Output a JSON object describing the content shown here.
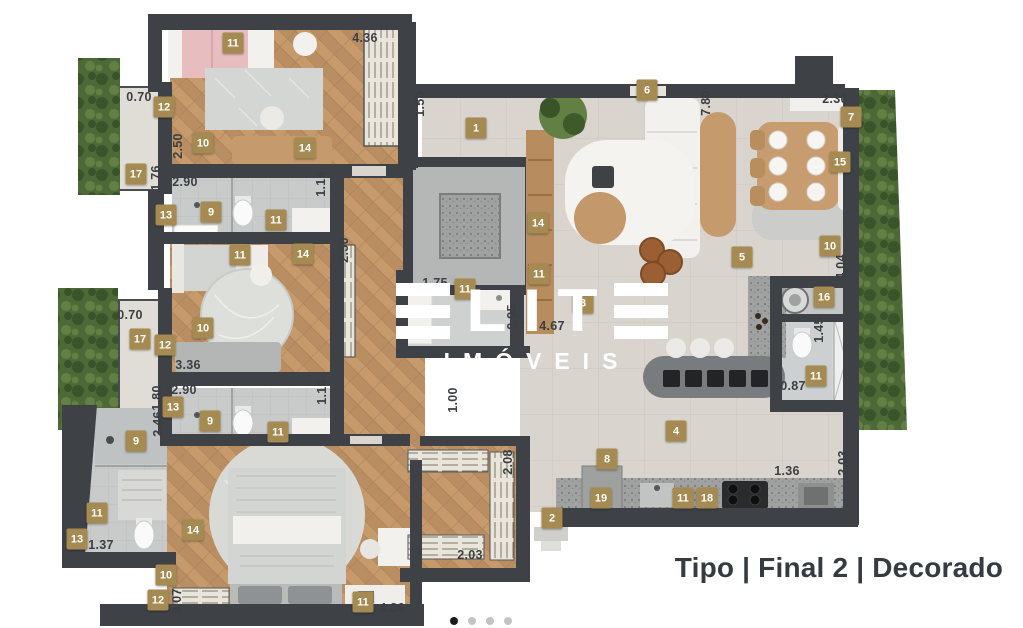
{
  "watermark": {
    "brand": "ELITE",
    "subtitle": "IMÓVEIS"
  },
  "caption": "Tipo | Final 2 | Decorado",
  "carousel": {
    "count": 4,
    "active_index": 0
  },
  "palette": {
    "wall": "#3e4247",
    "badge": "#a58b52",
    "wood": "#b98e63",
    "wood-light": "#c79a6c",
    "wood-dark": "#a87f55",
    "tile": "#d9d5ce",
    "tile-line": "#ccc7c0",
    "bath": "#c9cbca",
    "bath-line": "#bdbfbe",
    "green": "#4e6938",
    "green-dark": "#3a5429",
    "green-light": "#627f44",
    "counter": "#a0a2a1",
    "counter-dot": "#7c7e7d",
    "island": "#797c7e",
    "furn-white": "#f2f1ee",
    "furn-gray": "#d3d5d2",
    "furn-dark": "#8f9294",
    "pink": "#e8bdbf",
    "wardrobe": "#e9e5da",
    "wardrobe-tick": "#7a7668",
    "dim-text": "#3b3f43",
    "caption-text": "#343b41",
    "dot-active": "#1b1b1b",
    "dot-inactive": "#c3c3c3"
  },
  "badges": [
    {
      "n": "11",
      "x": 233,
      "y": 43
    },
    {
      "n": "12",
      "x": 164,
      "y": 107
    },
    {
      "n": "10",
      "x": 203,
      "y": 143
    },
    {
      "n": "14",
      "x": 305,
      "y": 148
    },
    {
      "n": "17",
      "x": 136,
      "y": 174
    },
    {
      "n": "13",
      "x": 166,
      "y": 215
    },
    {
      "n": "9",
      "x": 211,
      "y": 212
    },
    {
      "n": "11",
      "x": 276,
      "y": 220
    },
    {
      "n": "11",
      "x": 240,
      "y": 255
    },
    {
      "n": "14",
      "x": 303,
      "y": 254
    },
    {
      "n": "10",
      "x": 203,
      "y": 328
    },
    {
      "n": "17",
      "x": 140,
      "y": 339
    },
    {
      "n": "12",
      "x": 165,
      "y": 345
    },
    {
      "n": "13",
      "x": 173,
      "y": 407
    },
    {
      "n": "9",
      "x": 210,
      "y": 421
    },
    {
      "n": "11",
      "x": 278,
      "y": 432
    },
    {
      "n": "9",
      "x": 136,
      "y": 441
    },
    {
      "n": "11",
      "x": 97,
      "y": 513
    },
    {
      "n": "13",
      "x": 77,
      "y": 539
    },
    {
      "n": "14",
      "x": 193,
      "y": 530
    },
    {
      "n": "10",
      "x": 166,
      "y": 575
    },
    {
      "n": "12",
      "x": 158,
      "y": 600
    },
    {
      "n": "11",
      "x": 363,
      "y": 602
    },
    {
      "n": "1",
      "x": 476,
      "y": 128
    },
    {
      "n": "6",
      "x": 647,
      "y": 90
    },
    {
      "n": "7",
      "x": 851,
      "y": 117
    },
    {
      "n": "15",
      "x": 840,
      "y": 162
    },
    {
      "n": "5",
      "x": 742,
      "y": 257
    },
    {
      "n": "10",
      "x": 830,
      "y": 246
    },
    {
      "n": "14",
      "x": 538,
      "y": 223
    },
    {
      "n": "11",
      "x": 539,
      "y": 274
    },
    {
      "n": "11",
      "x": 465,
      "y": 289
    },
    {
      "n": "3",
      "x": 583,
      "y": 303
    },
    {
      "n": "16",
      "x": 824,
      "y": 297
    },
    {
      "n": "11",
      "x": 816,
      "y": 376
    },
    {
      "n": "4",
      "x": 676,
      "y": 431
    },
    {
      "n": "8",
      "x": 607,
      "y": 459
    },
    {
      "n": "19",
      "x": 601,
      "y": 498
    },
    {
      "n": "11",
      "x": 683,
      "y": 498
    },
    {
      "n": "18",
      "x": 707,
      "y": 498
    },
    {
      "n": "2",
      "x": 552,
      "y": 518
    }
  ],
  "dimensions": [
    {
      "t": "4.36",
      "x": 365,
      "y": 38,
      "v": false
    },
    {
      "t": "1.50",
      "x": 420,
      "y": 104,
      "v": true
    },
    {
      "t": "0.70",
      "x": 139,
      "y": 97,
      "v": false
    },
    {
      "t": "2.50",
      "x": 178,
      "y": 146,
      "v": true
    },
    {
      "t": "1.76",
      "x": 156,
      "y": 178,
      "v": true
    },
    {
      "t": "2.90",
      "x": 185,
      "y": 182,
      "v": false
    },
    {
      "t": "1.16",
      "x": 321,
      "y": 184,
      "v": true
    },
    {
      "t": "2.50",
      "x": 344,
      "y": 250,
      "v": true
    },
    {
      "t": "0.70",
      "x": 130,
      "y": 315,
      "v": false
    },
    {
      "t": "3.36",
      "x": 188,
      "y": 365,
      "v": false
    },
    {
      "t": "2.90",
      "x": 184,
      "y": 390,
      "v": false
    },
    {
      "t": "1.80",
      "x": 157,
      "y": 398,
      "v": true
    },
    {
      "t": "1.16",
      "x": 322,
      "y": 392,
      "v": true
    },
    {
      "t": "2.46",
      "x": 158,
      "y": 424,
      "v": true
    },
    {
      "t": "1.37",
      "x": 101,
      "y": 545,
      "v": false
    },
    {
      "t": "3.07",
      "x": 177,
      "y": 601,
      "v": true
    },
    {
      "t": "4.36",
      "x": 392,
      "y": 608,
      "v": false
    },
    {
      "t": "2.08",
      "x": 508,
      "y": 462,
      "v": true
    },
    {
      "t": "2.03",
      "x": 470,
      "y": 555,
      "v": false
    },
    {
      "t": "1.75",
      "x": 435,
      "y": 283,
      "v": false
    },
    {
      "t": "0.95",
      "x": 512,
      "y": 317,
      "v": true
    },
    {
      "t": "4.67",
      "x": 552,
      "y": 326,
      "v": false
    },
    {
      "t": "1.00",
      "x": 453,
      "y": 400,
      "v": true
    },
    {
      "t": "7.80",
      "x": 706,
      "y": 103,
      "v": true
    },
    {
      "t": "2.30",
      "x": 835,
      "y": 99,
      "v": false
    },
    {
      "t": "4.04",
      "x": 841,
      "y": 267,
      "v": true
    },
    {
      "t": "1.45",
      "x": 819,
      "y": 330,
      "v": true
    },
    {
      "t": "0.87",
      "x": 793,
      "y": 386,
      "v": false
    },
    {
      "t": "1.36",
      "x": 787,
      "y": 471,
      "v": false
    },
    {
      "t": "2.03",
      "x": 843,
      "y": 463,
      "v": true
    }
  ]
}
